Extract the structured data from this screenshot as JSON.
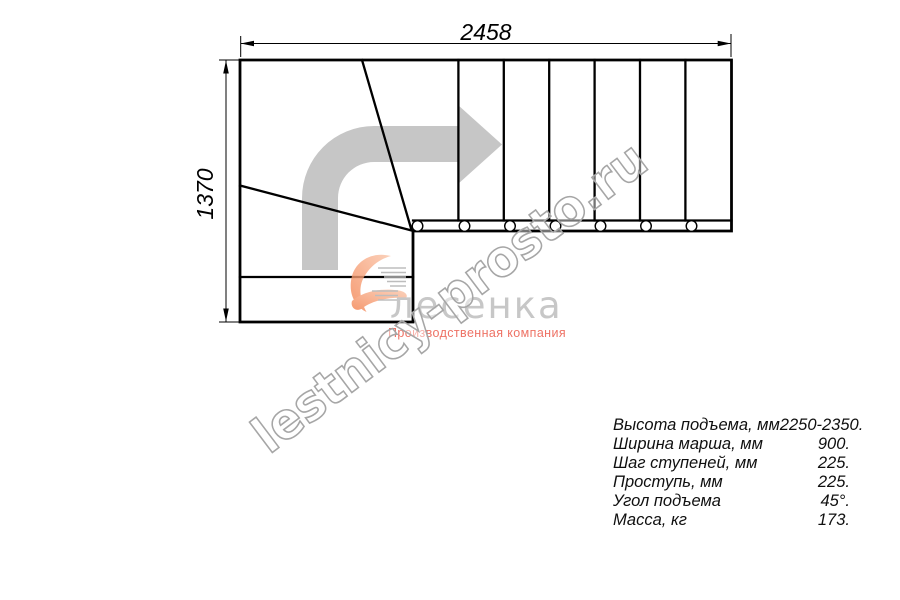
{
  "drawing": {
    "width_label": "2458",
    "height_label": "1370",
    "line_color": "#000000",
    "arrow_color": "#c6c6c6"
  },
  "watermark": {
    "text": "lestnicy-prosto.ru",
    "outline_color": "#a6a6a6"
  },
  "logo": {
    "name": "лесенка",
    "subtitle": "Производственная компания",
    "accent_color": "#f4916b",
    "name_color": "#c7c7c7",
    "subtitle_color": "#ee7265"
  },
  "specs": {
    "rows": [
      {
        "label": "Высота подъема, мм",
        "value": "2250-2350."
      },
      {
        "label": "Ширина марша, мм",
        "value": "900."
      },
      {
        "label": "Шаг ступеней, мм",
        "value": "225."
      },
      {
        "label": "Проступь, мм",
        "value": "225."
      },
      {
        "label": "Угол подъема",
        "value": "45°."
      },
      {
        "label": "Масса, кг",
        "value": "173."
      }
    ]
  }
}
